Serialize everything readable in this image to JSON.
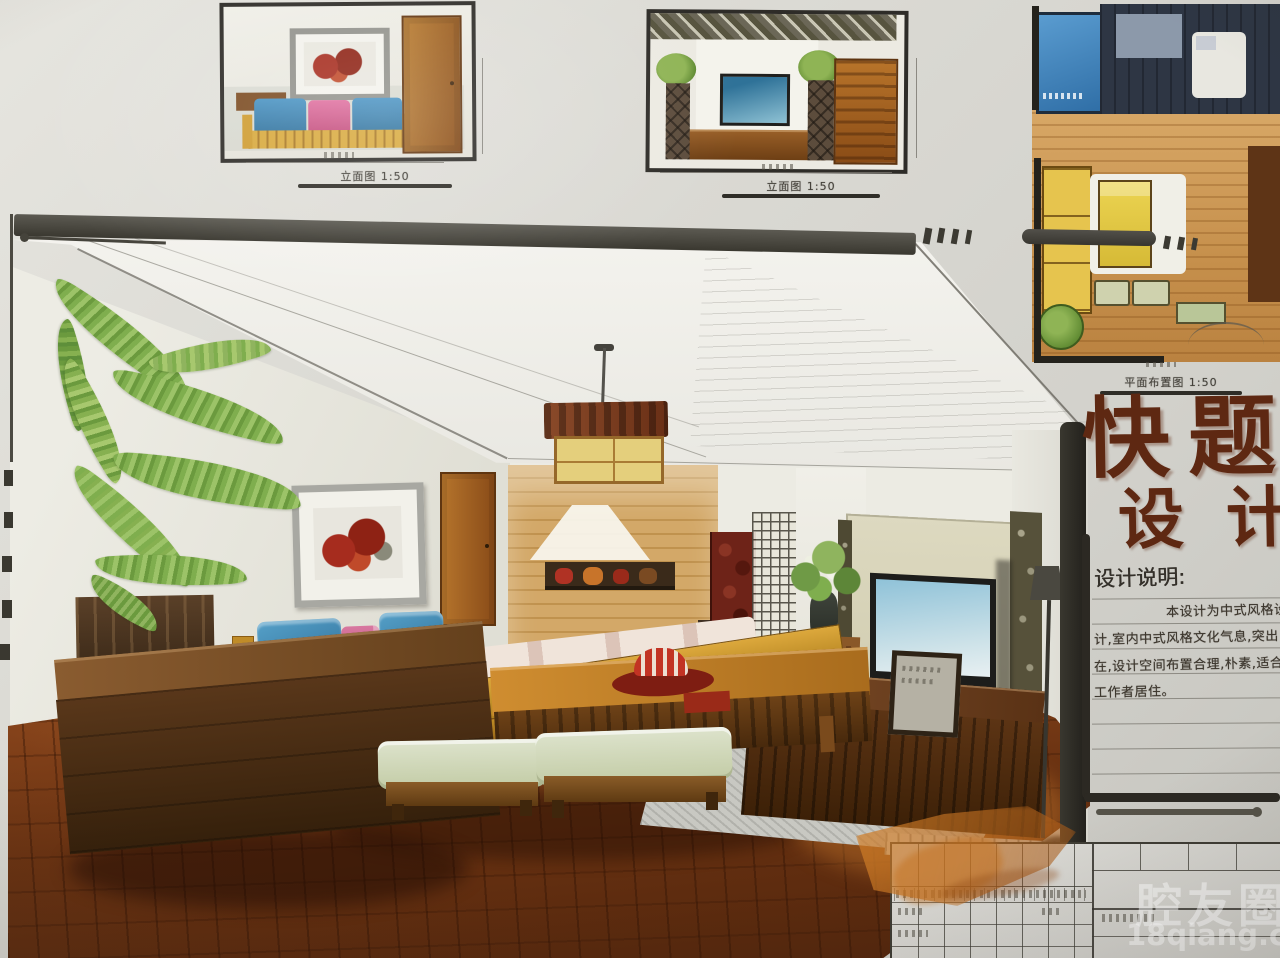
{
  "board": {
    "elevation_left": {
      "label": "立面图 1:50"
    },
    "elevation_center": {
      "label": "立面图 1:50"
    },
    "floor_plan": {
      "label": "平面布置图 1:50"
    },
    "main_title": {
      "line1": "快题",
      "line2": "设计"
    },
    "design_notes": {
      "heading": "设计说明:",
      "lines": [
        "本设计为中式风格设",
        "计,室内中式风格文化气息,突出",
        "在,设计空间布置合理,朴素,适合",
        "工作者居住。"
      ]
    }
  },
  "watermark": {
    "site_name": "腔友圈",
    "site_url": "18qiang.com"
  },
  "palette": {
    "paper": "#d9d8d2",
    "floor_wood": "#7a3c16",
    "furniture_wood": "#c08a3e",
    "sofa_blue": "#3f85b8",
    "pillow_pink": "#d06090",
    "plant_green": "#7fae4e",
    "calligraphy_brown": "#5e2812",
    "marker_black": "#2c2923"
  }
}
